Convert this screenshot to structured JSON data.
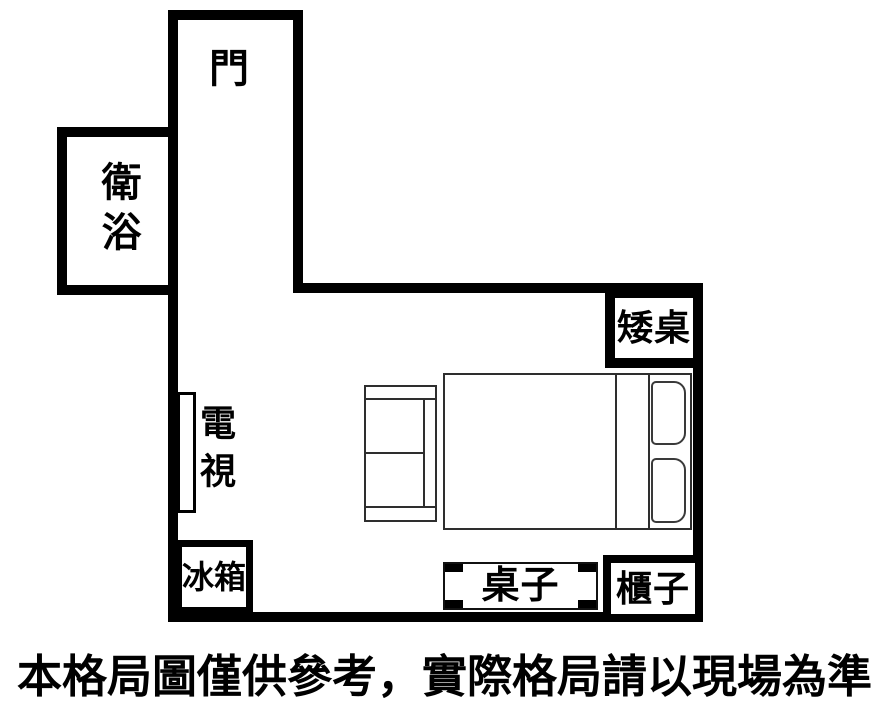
{
  "floorplan": {
    "door_label": "門",
    "bathroom_label": "衛浴",
    "low_table_label": "矮桌",
    "tv_label": "電視",
    "fridge_label": "冰箱",
    "desk_label": "桌子",
    "cabinet_label": "櫃子"
  },
  "caption": "本格局圖僅供參考，實際格局請以現場為準",
  "colors": {
    "wall": "#000000",
    "background": "#ffffff",
    "furniture_line": "#2e2e2e",
    "text": "#000000"
  }
}
